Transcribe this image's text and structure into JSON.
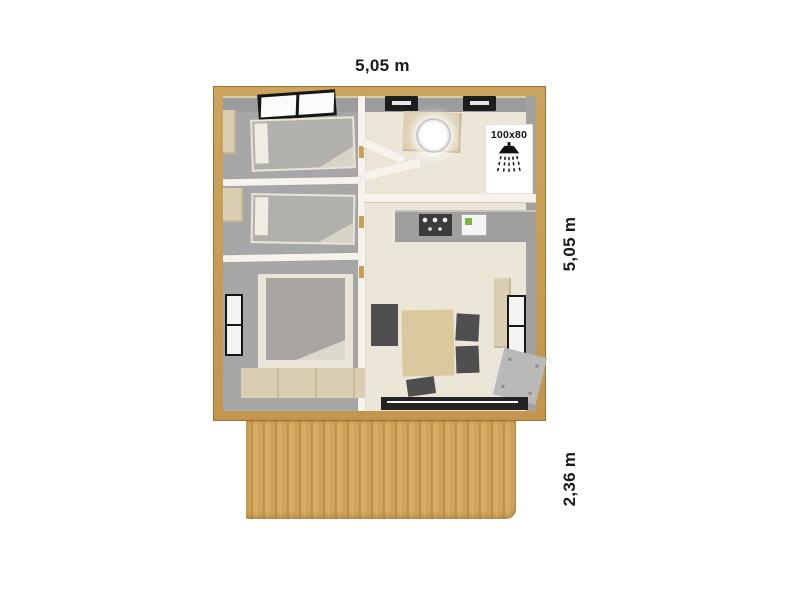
{
  "figure": {
    "type": "floor-plan",
    "description_labels_visible": [
      "5,05 m",
      "5,05 m",
      "2,36 m",
      "100x80"
    ]
  },
  "dimensions": {
    "top_width": "5,05 m",
    "right_depth": "5,05 m",
    "terrace_depth": "2,36 m"
  },
  "shower": {
    "size_label": "100x80"
  },
  "icons": [
    {
      "name": "shower-icon",
      "meaning": "shower head with water spray"
    }
  ],
  "colors": {
    "background": "#ffffff",
    "wood_frame": "#c99f58",
    "wood_frame_edge": "#9a7337",
    "deck_wood": "#cfa45c",
    "bedroom_floor": "#a8a7a7",
    "living_floor": "#ece6d9",
    "wall_white": "#f6f3ec",
    "furniture_beige": "#dbcfb3",
    "bed_gray": "#b2b0ad",
    "chair_dark": "#4f4f4f",
    "table_tan": "#dac89f",
    "window_frame": "#161616",
    "window_pane": "#fbfbfa",
    "label_text": "#1a1a1a"
  }
}
